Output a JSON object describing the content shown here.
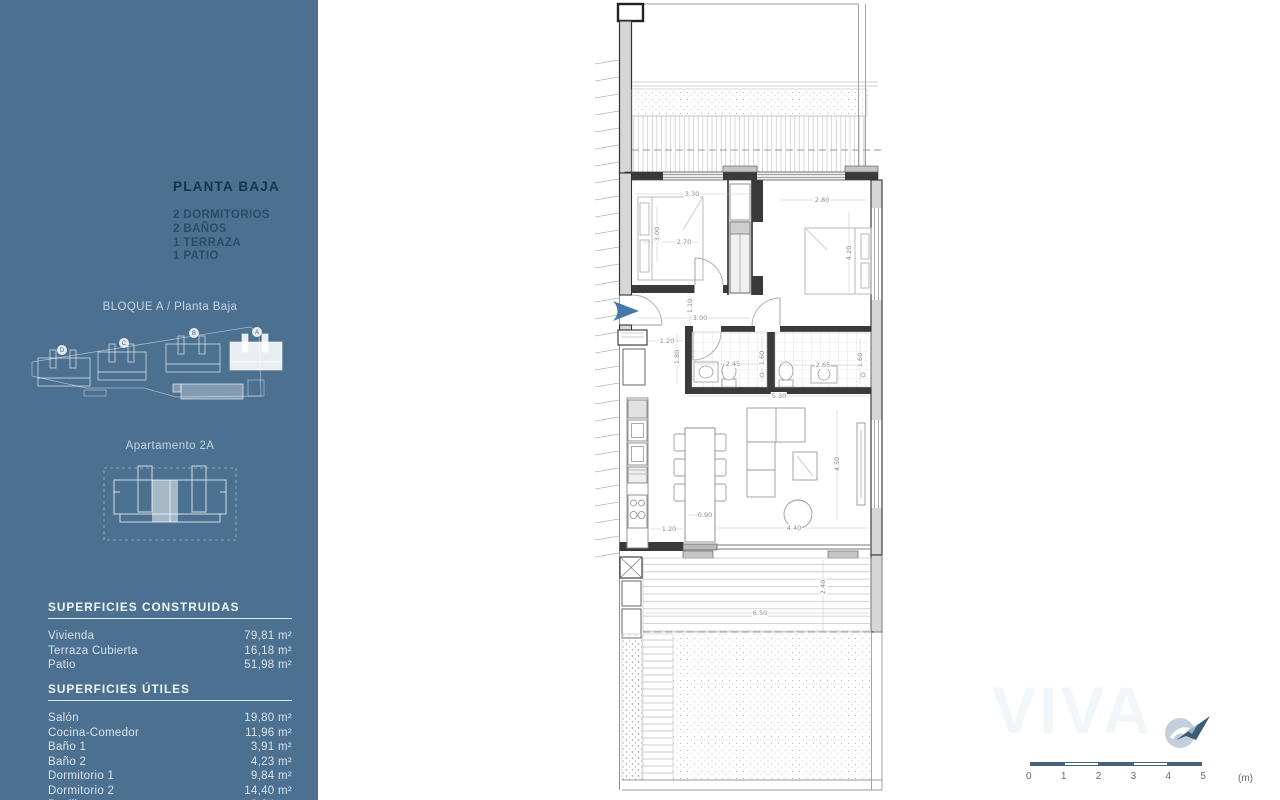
{
  "sidebar": {
    "title": "PLANTA BAJA",
    "features": [
      "2 DORMITORIOS",
      "2 BAÑOS",
      "1 TERRAZA",
      "1 PATIO"
    ],
    "block_caption": "BLOQUE A / Planta Baja",
    "site_plan": {
      "building_labels": [
        "D",
        "C",
        "B",
        "A"
      ]
    },
    "apartment_caption": "Apartamento 2A",
    "built": {
      "title": "SUPERFICIES CONSTRUIDAS",
      "rows": [
        {
          "label": "Vivienda",
          "value": "79,81 m²"
        },
        {
          "label": "Terraza Cubierta",
          "value": "16,18 m²"
        },
        {
          "label": "Patio",
          "value": "51,98 m²"
        }
      ]
    },
    "useful": {
      "title": "SUPERFICIES ÚTILES",
      "rows": [
        {
          "label": "Salón",
          "value": "19,80 m²"
        },
        {
          "label": "Cocina-Comedor",
          "value": "11,96 m²"
        },
        {
          "label": "Baño 1",
          "value": "3,91 m²"
        },
        {
          "label": "Baño 2",
          "value": "4,23 m²"
        },
        {
          "label": "Dormitorio 1",
          "value": "9,84 m²"
        },
        {
          "label": "Dormitorio 2",
          "value": "14,40 m²"
        },
        {
          "label": "Pasillo",
          "value": "3,84 m²"
        }
      ]
    }
  },
  "plan": {
    "dimensions": [
      {
        "t": "3.30",
        "x": 97,
        "y": 194,
        "r": 0
      },
      {
        "t": "2.80",
        "x": 227,
        "y": 200,
        "r": 0
      },
      {
        "t": "3.00",
        "x": 62,
        "y": 234,
        "r": -90
      },
      {
        "t": "2.70",
        "x": 89,
        "y": 242,
        "r": 0
      },
      {
        "t": "4.20",
        "x": 254,
        "y": 253,
        "r": -90
      },
      {
        "t": "1.10",
        "x": 95,
        "y": 306,
        "r": -90
      },
      {
        "t": "3.00",
        "x": 105,
        "y": 318,
        "r": 0
      },
      {
        "t": "1.20",
        "x": 72,
        "y": 341,
        "r": 0
      },
      {
        "t": "1.80",
        "x": 82,
        "y": 357,
        "r": -90
      },
      {
        "t": "2.45",
        "x": 138,
        "y": 364,
        "r": 0
      },
      {
        "t": "1.60",
        "x": 167,
        "y": 358,
        "r": -90
      },
      {
        "t": "2.65",
        "x": 228,
        "y": 365,
        "r": 0
      },
      {
        "t": "1.60",
        "x": 265,
        "y": 360,
        "r": -90
      },
      {
        "t": "5.30",
        "x": 184,
        "y": 396,
        "r": 0
      },
      {
        "t": "4.50",
        "x": 242,
        "y": 464,
        "r": -90
      },
      {
        "t": "0.90",
        "x": 110,
        "y": 515,
        "r": 0
      },
      {
        "t": "1.20",
        "x": 74,
        "y": 529,
        "r": 0
      },
      {
        "t": "4.40",
        "x": 199,
        "y": 528,
        "r": 0
      },
      {
        "t": "6.50",
        "x": 165,
        "y": 613,
        "r": 0
      },
      {
        "t": "2.40",
        "x": 228,
        "y": 587,
        "r": -90
      }
    ]
  },
  "footer": {
    "scale_ticks": [
      "0",
      "1",
      "2",
      "3",
      "4",
      "5"
    ],
    "scale_unit": "(m)",
    "watermark": "VIVA"
  },
  "colors": {
    "sidebar_bg": "#4b7090",
    "entrance_arrow": "#4479a8",
    "scale_bar": "#46627b"
  }
}
